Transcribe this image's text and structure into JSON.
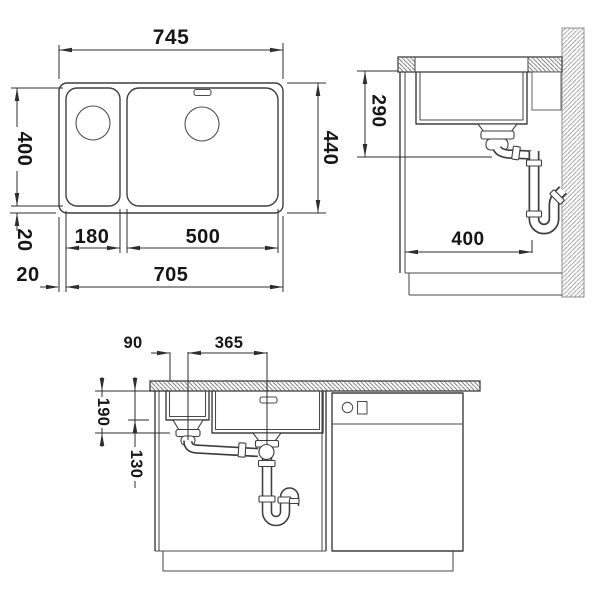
{
  "drawing": {
    "type": "technical-installation-drawing",
    "subject": "double-bowl undermount kitchen sink with cabinet, wall and drain plumbing",
    "colors": {
      "background": "#ffffff",
      "line": "#3e3e3e",
      "dimension_line": "#2e2e2e",
      "dimension_text": "#161616",
      "counter_hatch": "#6b6b6b",
      "wall_hatch": "#979797"
    },
    "views": {
      "top": {
        "overall_width": "745",
        "bowl_depth": "400",
        "overall_depth": "440",
        "rim_front": "20",
        "rim_side": "20",
        "small_bowl_width": "180",
        "main_bowl_width": "500",
        "inner_width": "705"
      },
      "side": {
        "clearance_below_worktop": "290",
        "drain_offset_from_front": "400"
      },
      "front": {
        "small_drain_offset": "90",
        "drain_spacing": "365",
        "main_bowl_depth": "190",
        "small_bowl_depth": "130"
      }
    }
  }
}
